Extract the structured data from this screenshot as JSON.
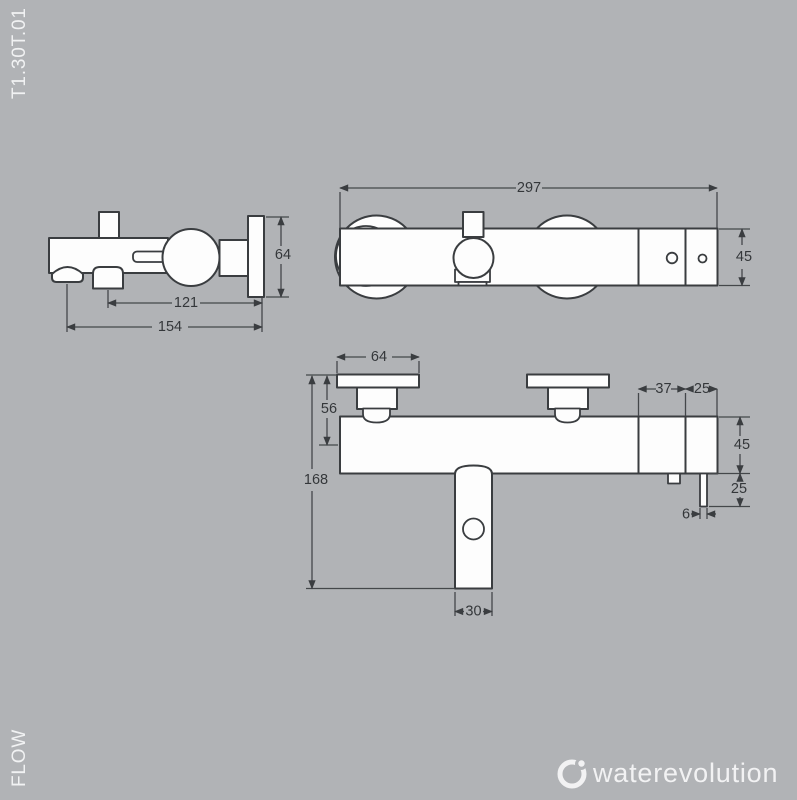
{
  "window": {
    "product_code": "T1.30T.01",
    "flow_label": "FLOW"
  },
  "logo": {
    "brand": "waterevolution",
    "icon": "water-drop-ring-icon"
  },
  "colors": {
    "background": "#b1b3b6",
    "outline": "#3a3d40",
    "shape_fill": "#fdfdfd",
    "dimension_text": "#34373a",
    "corner_text": "#f1f2f3"
  },
  "views": {
    "side_view": {
      "name": "side view",
      "dims": {
        "shower_outlet_to_wall": "121",
        "spout_to_wall": "154",
        "wall_plate_height": "64"
      }
    },
    "top_view": {
      "name": "top view",
      "dims": {
        "total_width": "297",
        "body_depth": "45"
      }
    },
    "front_view": {
      "name": "front view",
      "dims": {
        "escutcheon_width": "64",
        "flange_to_axis": "56",
        "total_height": "168",
        "handle_width": "30",
        "right_segment_a": "37",
        "right_segment_b": "25",
        "body_height": "45",
        "pin_drop": "25",
        "pin_width": "6"
      }
    }
  }
}
